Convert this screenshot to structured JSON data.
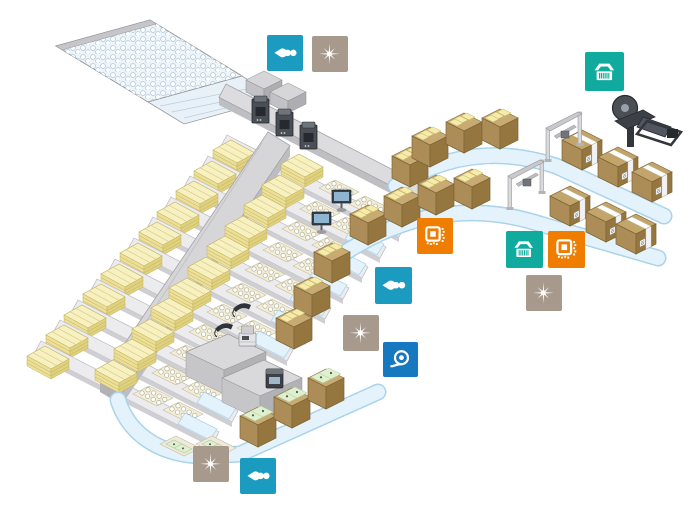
{
  "meta": {
    "title": "Isometric packaging and logistics line illustration",
    "canvas": {
      "width": 699,
      "height": 523
    },
    "background": "#ffffff"
  },
  "palette": {
    "cyan": "#1a9bbf",
    "teal": "#10ab9e",
    "orange": "#ef7d00",
    "taupe": "#a79a8d",
    "blue": "#1678be",
    "conveyor_gray": "#d9d9db",
    "walkway_gray": "#d2d2d4",
    "belt_blue": "#e3f2fb",
    "belt_edge": "#a9d3ea",
    "goods_yellow": "#f0e5a2",
    "carton_brown": "#ac8d58",
    "machine_dark": "#3c4147"
  },
  "icons": {
    "sensor-beam": "photoelectric-sensor-beam-dots",
    "laser-marker": "laser-marking-starburst",
    "barcode-reader": "barcode-scanner",
    "code-reader": "2d-code-reader",
    "label-roller": "label-roll-applicator"
  },
  "badges": [
    {
      "name": "sensor-badge-1",
      "icon": "sensor-beam",
      "color": "cyan",
      "x": 267,
      "y": 35,
      "size": 36
    },
    {
      "name": "laser-marker-badge-1",
      "icon": "laser-marker",
      "color": "taupe",
      "x": 312,
      "y": 36,
      "size": 36
    },
    {
      "name": "barcode-reader-badge-1",
      "icon": "barcode-reader",
      "color": "teal",
      "x": 585,
      "y": 52,
      "size": 39
    },
    {
      "name": "code-reader-badge-1",
      "icon": "code-reader",
      "color": "orange",
      "x": 417,
      "y": 218,
      "size": 36
    },
    {
      "name": "barcode-reader-badge-2",
      "icon": "barcode-reader",
      "color": "teal",
      "x": 506,
      "y": 231,
      "size": 37
    },
    {
      "name": "code-reader-badge-2",
      "icon": "code-reader",
      "color": "orange",
      "x": 548,
      "y": 231,
      "size": 37
    },
    {
      "name": "sensor-badge-2",
      "icon": "sensor-beam",
      "color": "cyan",
      "x": 375,
      "y": 267,
      "size": 37
    },
    {
      "name": "laser-marker-badge-2",
      "icon": "laser-marker",
      "color": "taupe",
      "x": 526,
      "y": 275,
      "size": 36
    },
    {
      "name": "laser-marker-badge-3",
      "icon": "laser-marker",
      "color": "taupe",
      "x": 343,
      "y": 315,
      "size": 36
    },
    {
      "name": "label-printer-badge-1",
      "icon": "label-roller",
      "color": "blue",
      "x": 383,
      "y": 342,
      "size": 35
    },
    {
      "name": "laser-marker-badge-4",
      "icon": "laser-marker",
      "color": "taupe",
      "x": 193,
      "y": 446,
      "size": 36
    },
    {
      "name": "sensor-badge-3",
      "icon": "sensor-beam",
      "color": "cyan",
      "x": 240,
      "y": 458,
      "size": 36
    }
  ],
  "scene": {
    "lanes": 11,
    "areas": [
      "infeed-accumulator",
      "main-walkway",
      "pallet-lanes",
      "tray-lanes",
      "case-packing-line",
      "carton-conveyor-loop",
      "inspection-gantries",
      "labeling-robot",
      "sealed-carton-outfeed"
    ]
  }
}
